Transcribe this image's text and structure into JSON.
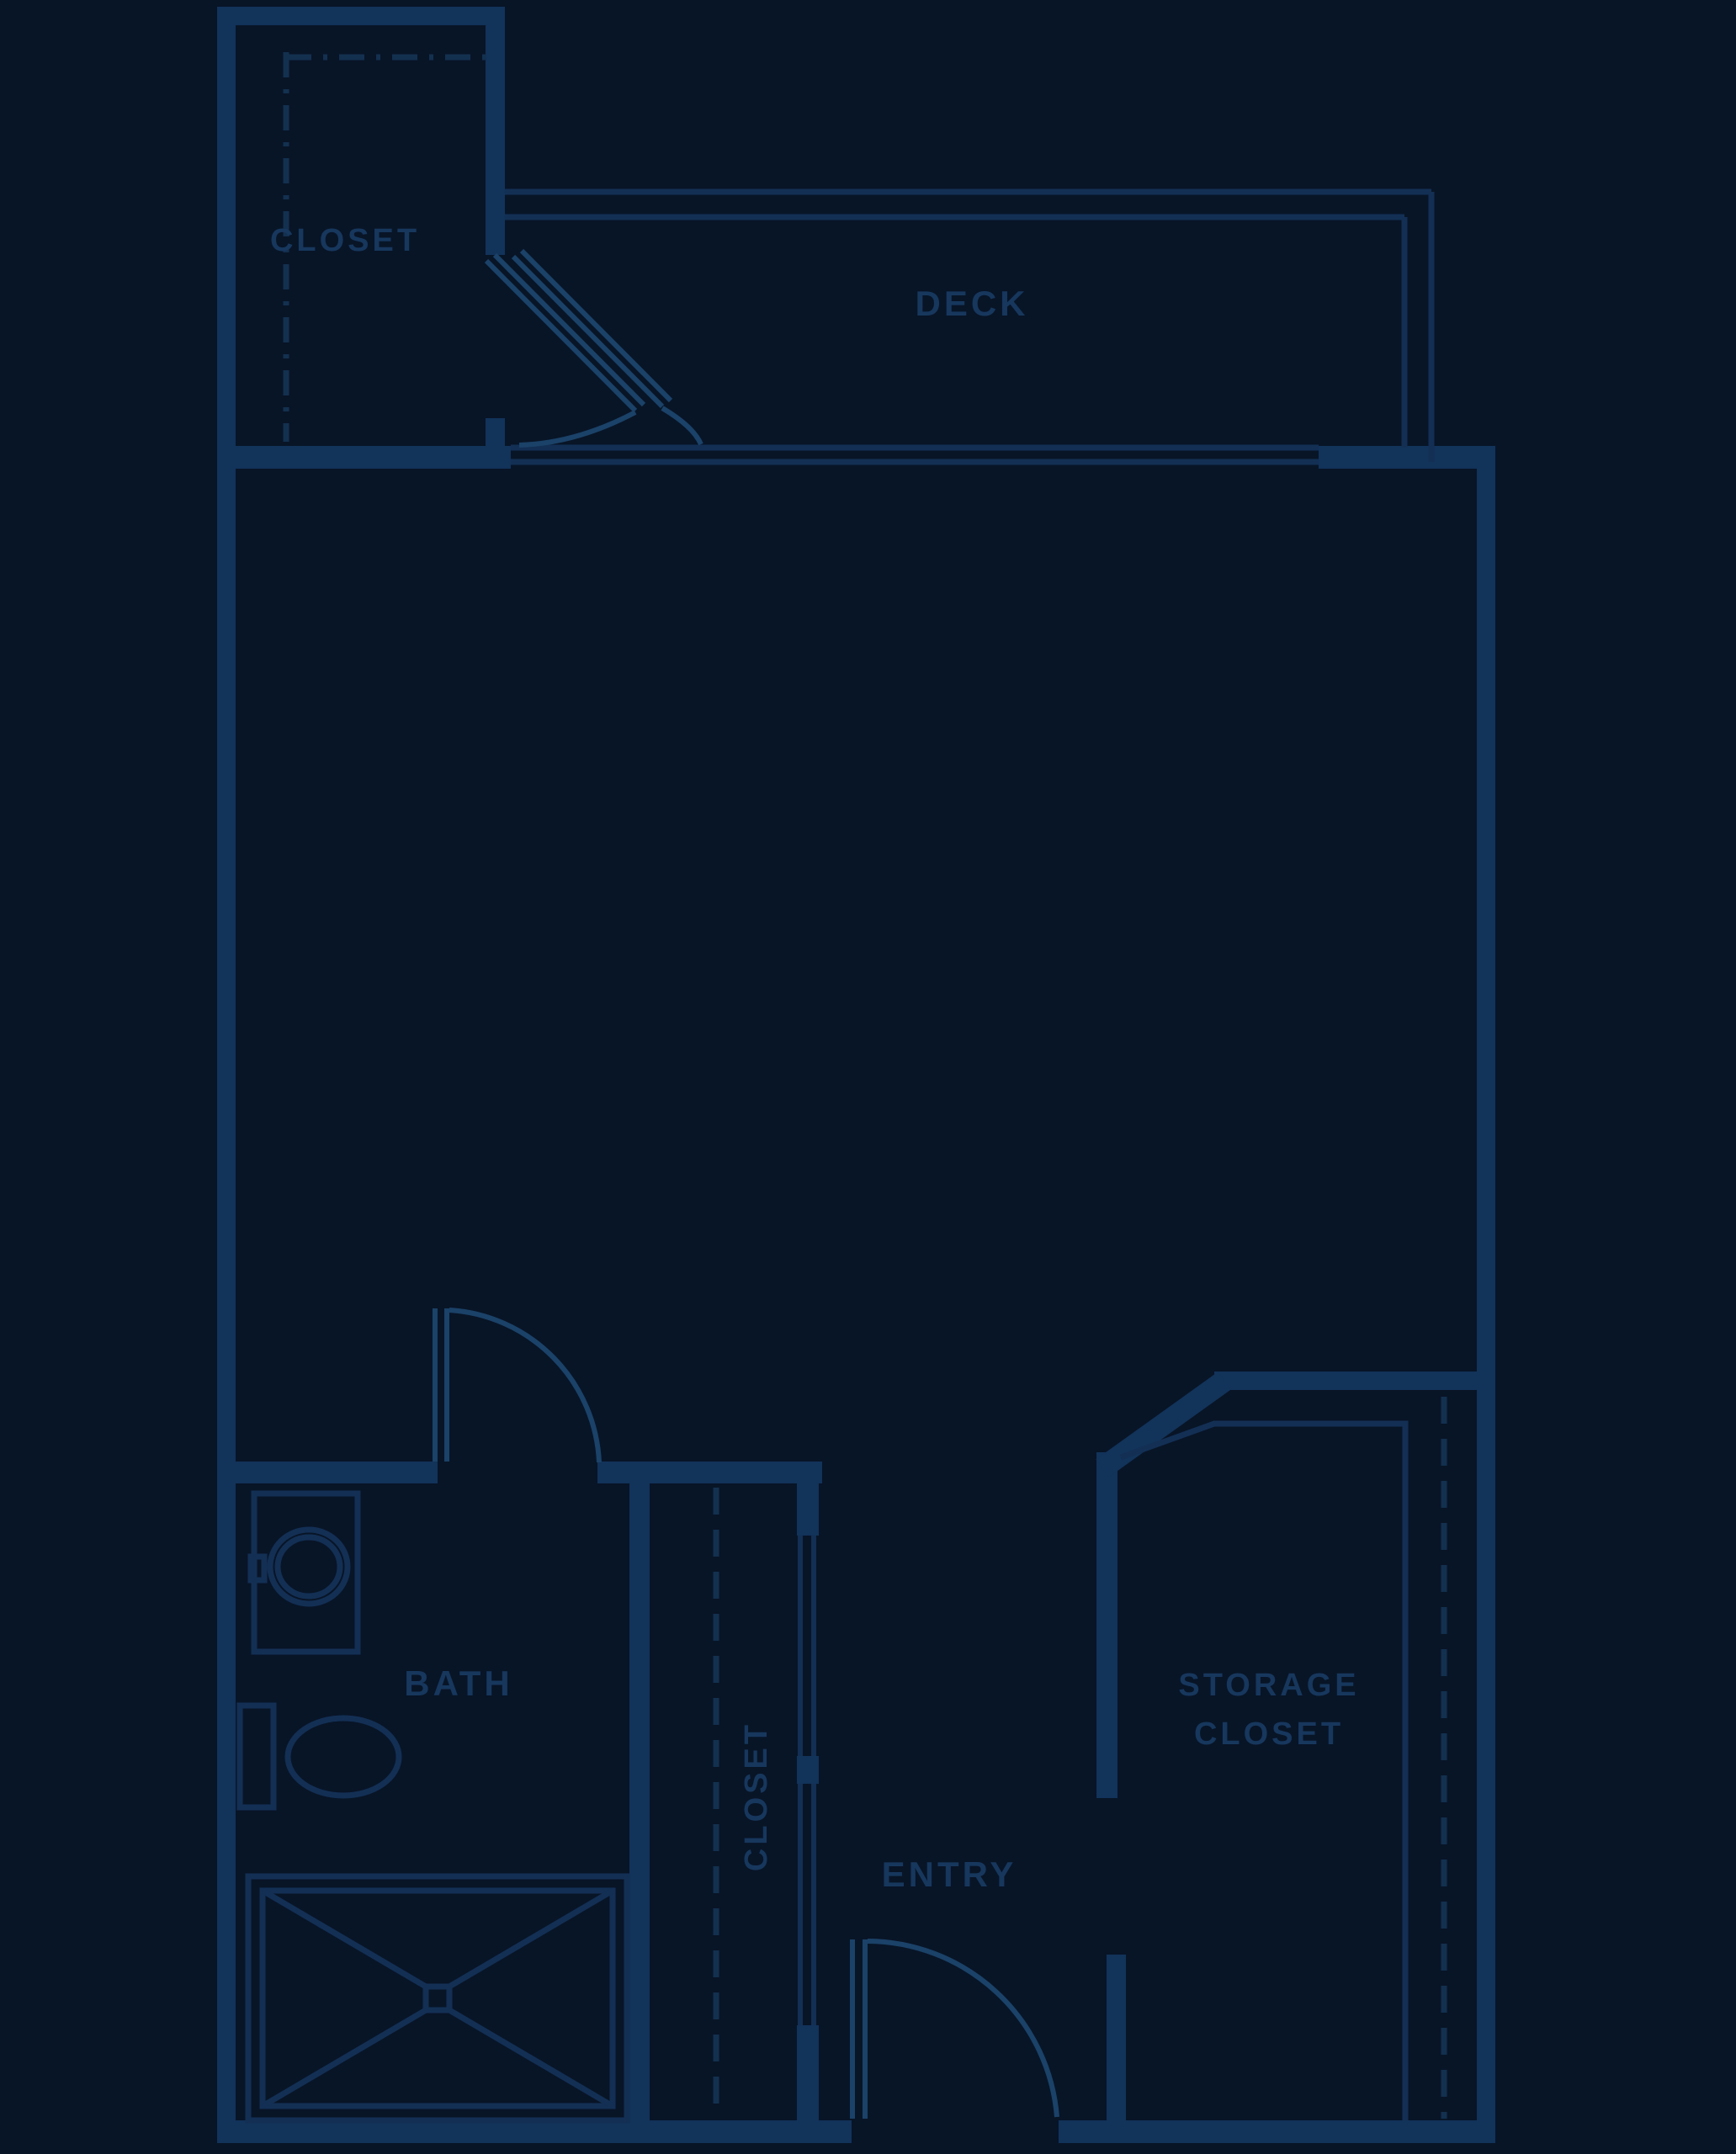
{
  "plan": {
    "type": "apartment-floor-plan",
    "style": "blueprint-dark",
    "colors": {
      "background": "#081527",
      "wall": "#12335a",
      "thin_line": "#132f54",
      "door": "#1b4268",
      "dashed_line": "#13304f",
      "text": "#17375d"
    },
    "rooms": {
      "closet_top": {
        "label": "CLOSET"
      },
      "deck": {
        "label": "DECK"
      },
      "bath": {
        "label": "BATH"
      },
      "hall_closet": {
        "label": "CLOSET",
        "orientation": "vertical"
      },
      "entry": {
        "label": "ENTRY"
      },
      "storage_closet": {
        "label_line1": "STORAGE",
        "label_line2": "CLOSET"
      }
    },
    "fixtures": [
      "bathroom-sink-vanity",
      "toilet",
      "shower-with-x",
      "closet-rod-dashed-lines",
      "swing-doors"
    ]
  }
}
